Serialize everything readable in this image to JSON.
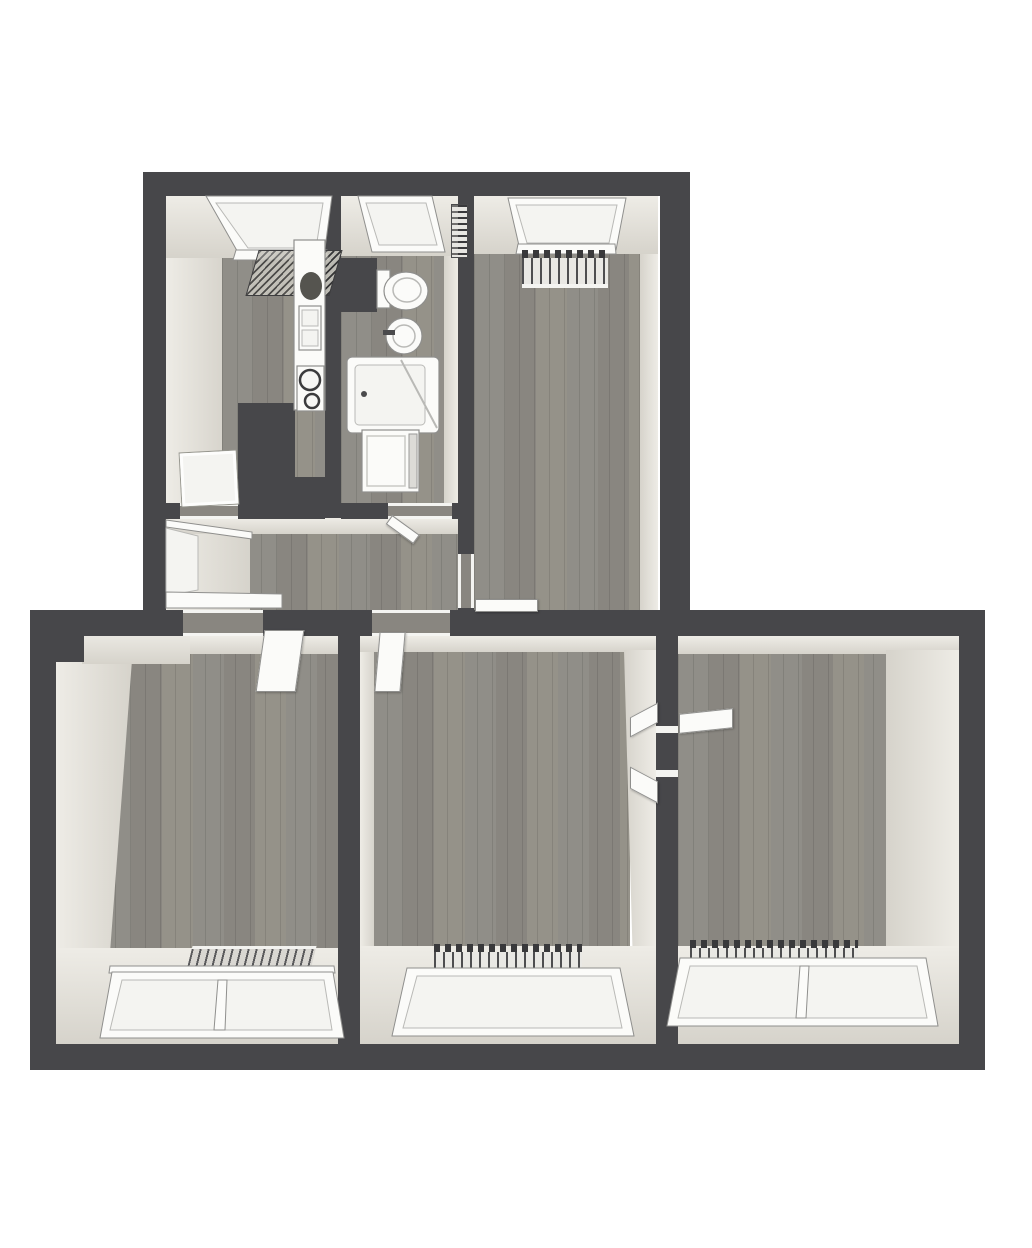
{
  "scene": {
    "type": "3d-floor-plan",
    "view": "top-down bird's-eye architectural render",
    "text_content": "none visible in image"
  },
  "colors": {
    "background": "#ffffff",
    "wall": "#47474a",
    "floor_a": "#908e88",
    "floor_b": "#898680",
    "floor_c": "#959289",
    "face_light": "#eeece6",
    "face_dark": "#d6d3cb",
    "fixture": "#fbfbf9",
    "glass": "#f4f4f1",
    "outline": "#8f8f8d",
    "radiator_dark": "#39393b",
    "radiator_light": "#e9e8e4"
  },
  "rooms": [
    {
      "id": "kitchen",
      "position": "top-left",
      "fixtures": [
        "window",
        "hatched-panel-radiator",
        "kitchen-counter",
        "counter-sink",
        "cooktop-two-burners",
        "open-glass-door"
      ]
    },
    {
      "id": "bathroom",
      "position": "top-middle",
      "fixtures": [
        "window",
        "towel-radiator",
        "toilet",
        "washbasin",
        "bathtub-with-glass",
        "washing-machine",
        "door-to-hallway"
      ]
    },
    {
      "id": "room-top-right",
      "position": "top-right",
      "fixtures": [
        "window",
        "column-radiator",
        "open-door-to-hallway"
      ]
    },
    {
      "id": "hallway",
      "position": "center-left",
      "fixtures": [
        "side-window",
        "window-sill",
        "door-openings"
      ]
    },
    {
      "id": "room-bottom-left",
      "position": "bottom-left",
      "fixtures": [
        "double-pane-window",
        "panel-radiator",
        "open-door-to-hallway",
        "wall-notch"
      ]
    },
    {
      "id": "room-bottom-middle",
      "position": "bottom-middle",
      "fixtures": [
        "wide-window",
        "column-radiator",
        "open-door-to-hallway",
        "door-to-right-room"
      ]
    },
    {
      "id": "room-bottom-right",
      "position": "bottom-right",
      "fixtures": [
        "double-pane-window",
        "column-radiator",
        "open-door-to-middle-room"
      ]
    }
  ]
}
